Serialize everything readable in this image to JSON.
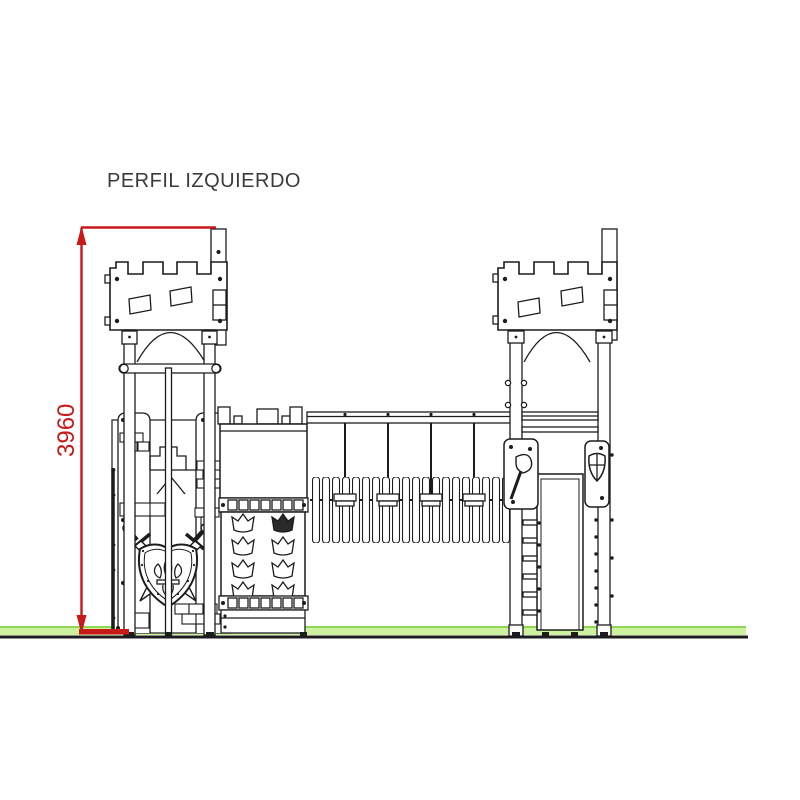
{
  "page": {
    "title": "PERFIL IZQUIERDO"
  },
  "dimension": {
    "value": "3960"
  },
  "colors": {
    "dimension": "#c81818",
    "line": "#1c1c1c",
    "ground_band": "#ccf2a0",
    "ground_edge": "#8ed653",
    "background": "#ffffff"
  },
  "components": [
    "left-castle-tower",
    "right-castle-tower",
    "rope-bridge",
    "crown-climbing-wall",
    "shield-and-swords-panel",
    "axe-panel",
    "shield-panel",
    "slide-channel",
    "ground-line",
    "height-dimension"
  ]
}
